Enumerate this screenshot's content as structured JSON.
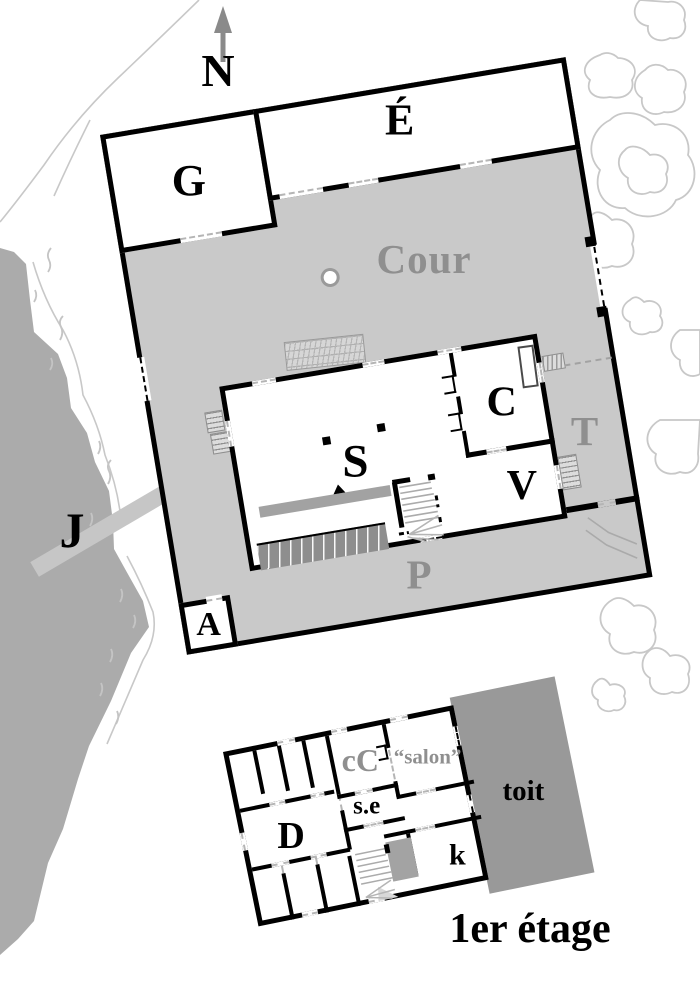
{
  "compass": {
    "label": "N"
  },
  "main_plan": {
    "rooms": {
      "g": "G",
      "e": "É",
      "a": "A"
    },
    "building": {
      "s": "S",
      "c": "C",
      "v": "V"
    },
    "labels": {
      "cour": "Cour",
      "p": "P",
      "t": "T",
      "j": "J"
    }
  },
  "first_floor": {
    "rooms": {
      "cc": "cC",
      "salon": "“salon”",
      "se": "s.e",
      "d": "D",
      "k": "k"
    },
    "roof": "toit",
    "caption": "1er étage"
  },
  "colors": {
    "water": "#ababab",
    "courtyard": "#c9c9c9",
    "roof_fill": "#999999",
    "gray_label": "#8f8f8f",
    "wall": "#000000",
    "contour": "#c8c8c8",
    "jetty": "#c6c6c6"
  }
}
